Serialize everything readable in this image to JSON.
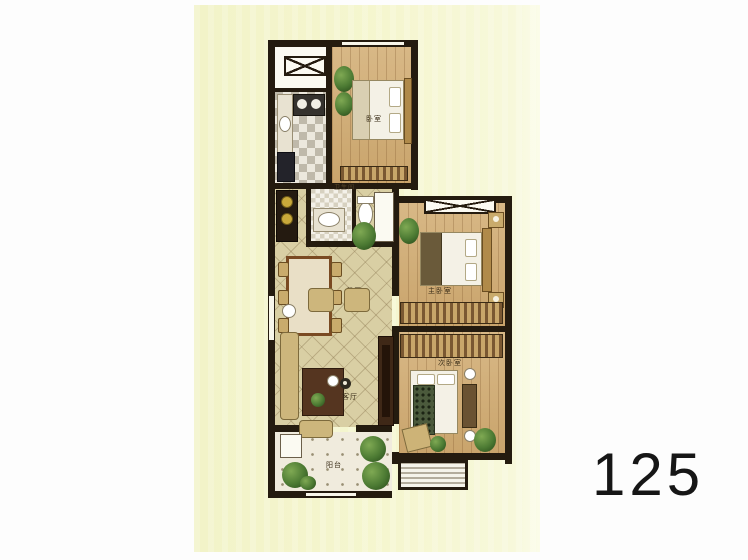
{
  "page": {
    "background_color": "#fdfdfd",
    "panel_color": "#f5f6cf",
    "wall_color": "#241b0f",
    "unit_number": "125"
  },
  "rooms": {
    "bedroom_top": "卧室",
    "master_bedroom": "主卧室",
    "second_bedroom": "次卧室",
    "dining": "餐厅",
    "living": "客厅",
    "balcony": "阳台",
    "bathroom": "卫生间"
  },
  "colors": {
    "wood_floor": "#cfa973",
    "tile_floor": "#d9cfa4",
    "kitchen_tile": "#ece8dd",
    "plant_green": "#4c7a33",
    "furniture_tan": "#c9b277",
    "table_brown": "#553520",
    "unit_number_text": "#161616"
  }
}
